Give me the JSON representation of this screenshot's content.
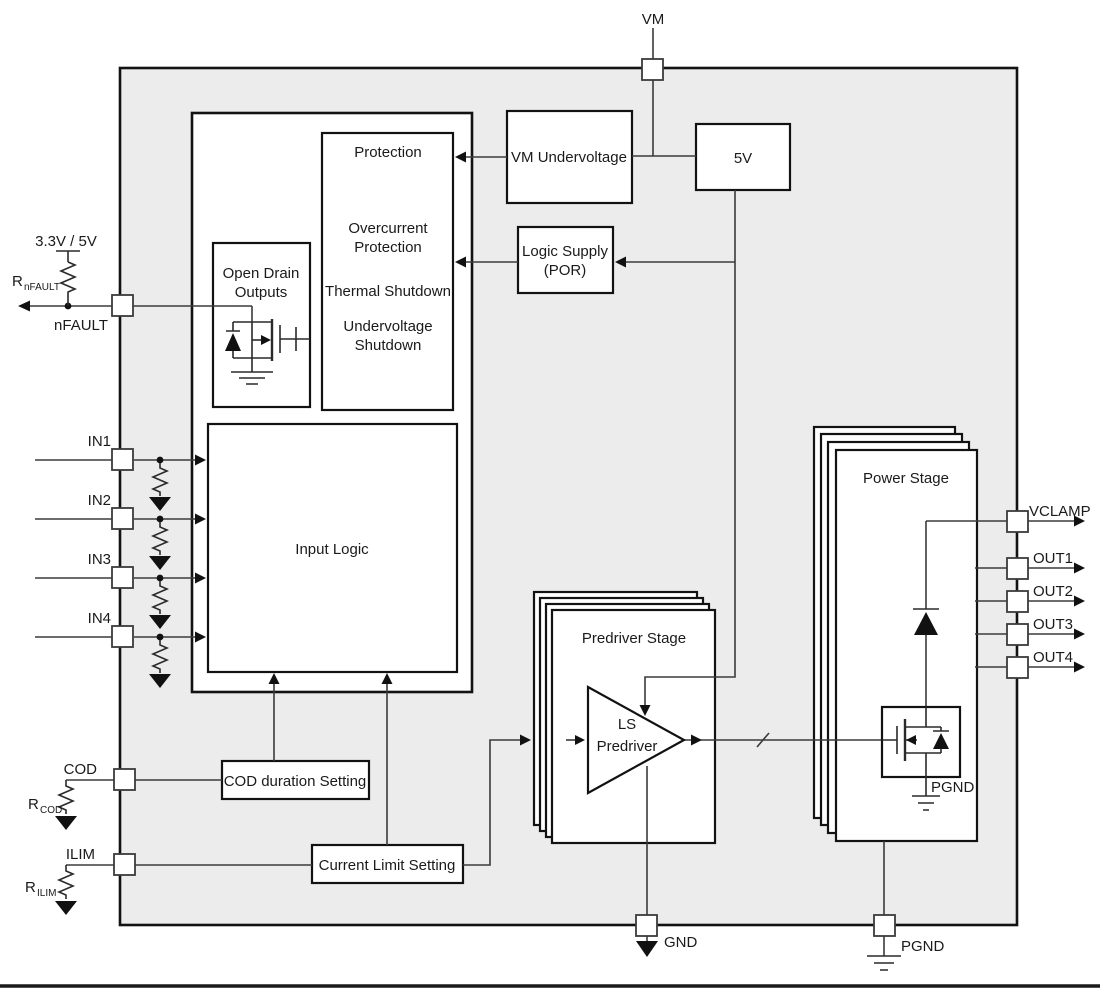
{
  "title": "Motor driver functional block diagram",
  "colors": {
    "chip_fill": "#ececec",
    "wire": "#3b3b3b",
    "box_border": "#121212",
    "text": "#1a1a1a"
  },
  "pins": {
    "vm": "VM",
    "nfault": "nFAULT",
    "in1": "IN1",
    "in2": "IN2",
    "in3": "IN3",
    "in4": "IN4",
    "cod": "COD",
    "ilim": "ILIM",
    "gnd": "GND",
    "pgnd": "PGND",
    "vclamp": "VCLAMP",
    "out1": "OUT1",
    "out2": "OUT2",
    "out3": "OUT3",
    "out4": "OUT4"
  },
  "external": {
    "supply": "3.3V / 5V",
    "r_base": "R",
    "r_nfault_sub": "nFAULT",
    "r_cod_sub": "COD",
    "r_ilim_sub": "ILIM"
  },
  "blocks": {
    "vm_undervoltage": "VM Undervoltage",
    "five_v": "5V",
    "logic_supply_1": "Logic Supply",
    "logic_supply_2": "(POR)",
    "protection_title": "Protection",
    "protection_l1": "Overcurrent",
    "protection_l2": "Protection",
    "protection_l3": "Thermal Shutdown",
    "protection_l4": "Undervoltage",
    "protection_l5": "Shutdown",
    "open_drain_1": "Open Drain",
    "open_drain_2": "Outputs",
    "input_logic": "Input Logic",
    "cod_setting": "COD duration Setting",
    "current_limit": "Current Limit Setting",
    "predriver_stage": "Predriver Stage",
    "ls_predriver_1": "LS",
    "ls_predriver_2": "Predriver",
    "power_stage": "Power Stage",
    "pgnd_internal": "PGND"
  }
}
